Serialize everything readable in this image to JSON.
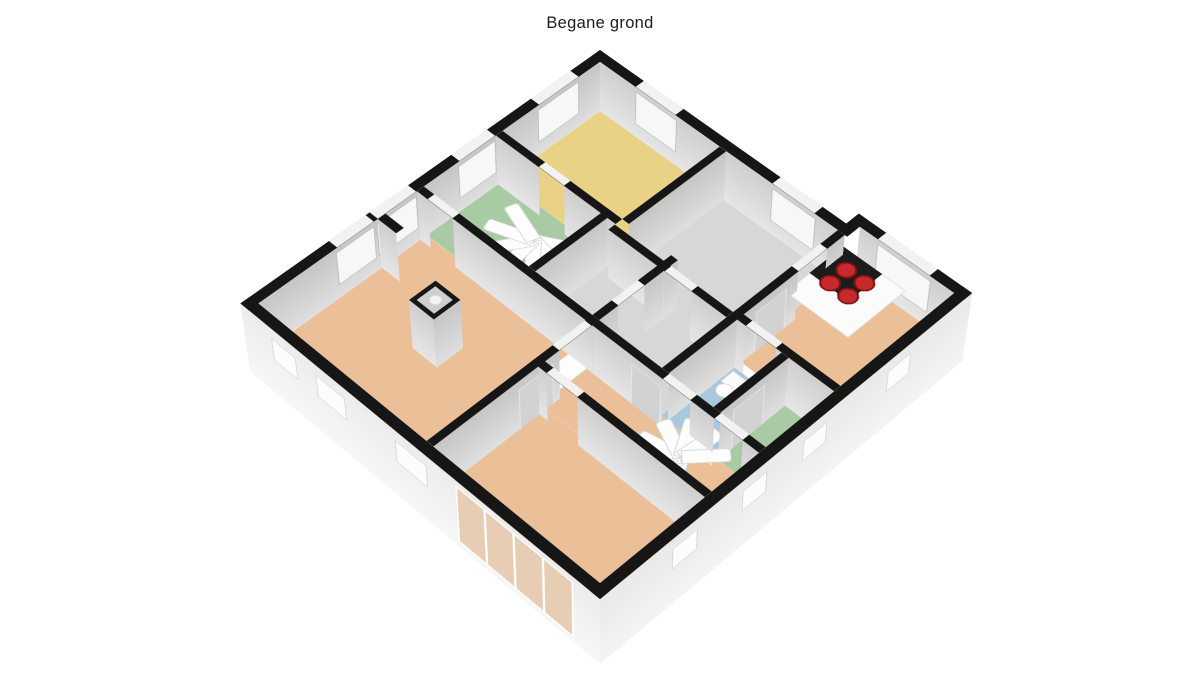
{
  "title": "Begane grond",
  "view": {
    "type": "3d-floorplan",
    "floor_label": "Begane grond"
  },
  "palette": {
    "background": "#ffffff",
    "wall_top": "#161616",
    "wall_face_light": "#e2e2e2",
    "wall_face_dark": "#c9c9c9",
    "exterior_face": "#f0f0f0",
    "window": "#f7f7f7",
    "door_gap": "#f2f2f2",
    "door_panel": "#d2d2d2",
    "stair": "#fdfdfd",
    "counter": "#fbfbfb",
    "cooktop": "#1c1c1c",
    "burner": "#c62a2a"
  },
  "rooms": [
    {
      "id": "bedroom-north",
      "label": "bedroom north",
      "floor_color": "#e9d186"
    },
    {
      "id": "study",
      "label": "study",
      "floor_color": "#d7d7d7"
    },
    {
      "id": "kitchen",
      "label": "kitchen",
      "floor_color": "#ebc098"
    },
    {
      "id": "stair-room",
      "label": "stair room",
      "floor_color": "#a9cba4"
    },
    {
      "id": "bathroom",
      "label": "bathroom",
      "floor_color": "#d7d7d7"
    },
    {
      "id": "hall-north",
      "label": "hall north",
      "floor_color": "#d7d7d7"
    },
    {
      "id": "wc",
      "label": "toilet room",
      "floor_color": "#a9c8de"
    },
    {
      "id": "storage",
      "label": "storage room",
      "floor_color": "#a9cba4"
    },
    {
      "id": "living-room",
      "label": "living room",
      "floor_color": "#ebc098"
    },
    {
      "id": "hall-south",
      "label": "stair hall",
      "floor_color": "#ebc098"
    },
    {
      "id": "bedroom-south",
      "label": "bedroom south",
      "floor_color": "#ebc098"
    }
  ],
  "features": [
    {
      "id": "chimney",
      "label": "chimney column"
    },
    {
      "id": "spiral-stair-north",
      "label": "spiral staircase north"
    },
    {
      "id": "spiral-stair-south",
      "label": "spiral staircase south"
    },
    {
      "id": "kitchen-counter",
      "label": "kitchen counter"
    },
    {
      "id": "cooktop",
      "label": "4-burner cooktop"
    },
    {
      "id": "toilet",
      "label": "toilet"
    },
    {
      "id": "sink",
      "label": "hand basin"
    },
    {
      "id": "shower",
      "label": "shower tray"
    },
    {
      "id": "cabinet",
      "label": "cabinet"
    },
    {
      "id": "sliding-door",
      "label": "sliding glass door"
    }
  ]
}
